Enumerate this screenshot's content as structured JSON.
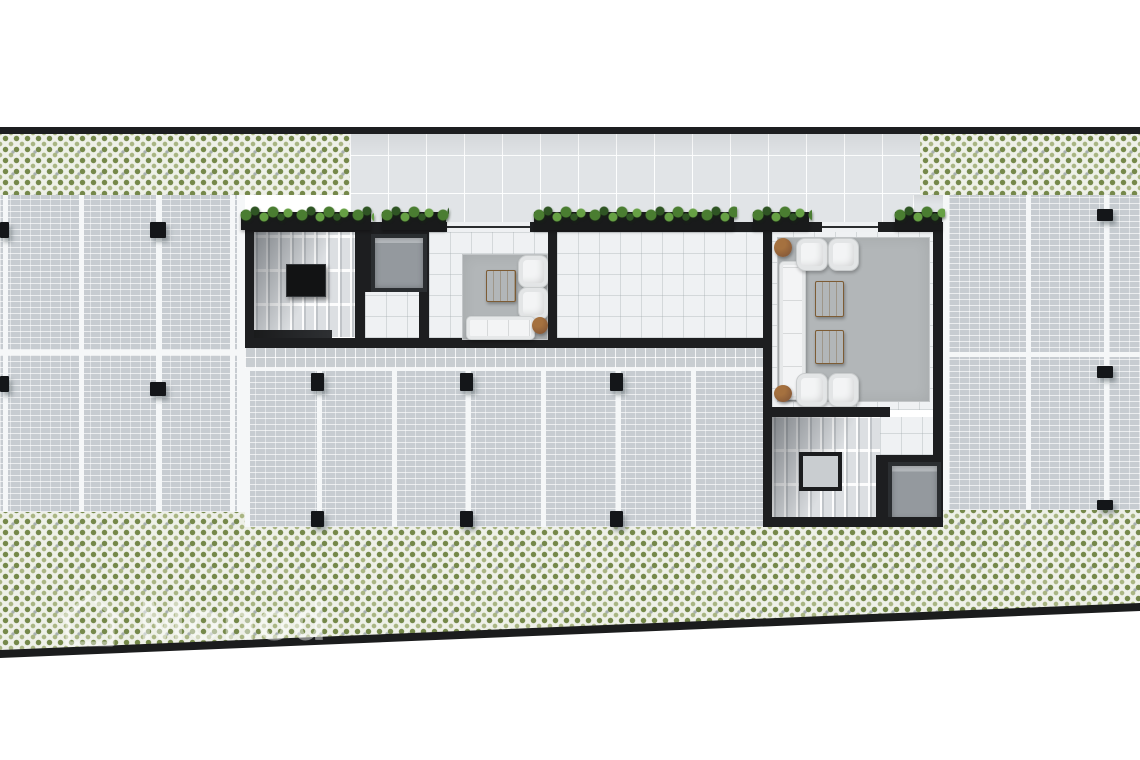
{
  "watermark": {
    "text": "Monod",
    "icon": "house-icon"
  },
  "palette": {
    "wall": "#1d1e20",
    "stripe": "#f5f7f8",
    "paver": "#c7ccd1",
    "plaza_tile": "#e1e4e7",
    "lobby_tile": "#eff1f3",
    "walkway_tile": "#c8cdd1",
    "green_base": "#eef0e8",
    "green_dot_dark": "#75884a",
    "green_dot_light": "#a9b583",
    "rug": "#b2b6b8",
    "sofa": "#f3f4f5",
    "wood": "#a8804e",
    "side_table": "#8a5c39",
    "plant_dark": "#2f5524",
    "plant_mid": "#4a7d31",
    "plant_light": "#66a044",
    "elevator_car": "#94999e"
  },
  "plan": {
    "type": "residential-building-ground-floor-render",
    "parking": {
      "left_block": {
        "rows": 2,
        "spaces_per_row": 3
      },
      "middle_block": {
        "rows": 1,
        "spaces": 7
      },
      "right_block": {
        "rows": 2,
        "spaces_per_row": 3
      }
    },
    "cores": [
      {
        "name": "west-core",
        "features": [
          "staircase",
          "elevator",
          "lounge"
        ]
      },
      {
        "name": "east-core",
        "features": [
          "lounge",
          "staircase",
          "elevator"
        ]
      }
    ],
    "west_lounge_furniture": [
      "sofa",
      "armchair",
      "armchair",
      "wood-coffee-table",
      "round-side-table"
    ],
    "east_lounge_furniture": [
      "sofa",
      "armchair",
      "armchair",
      "armchair",
      "armchair",
      "wood-coffee-table",
      "wood-coffee-table",
      "round-side-table",
      "round-side-table"
    ],
    "landscape": [
      "green-paver-band-top",
      "green-paver-band-bottom",
      "hedge-planters-along-facade"
    ]
  }
}
